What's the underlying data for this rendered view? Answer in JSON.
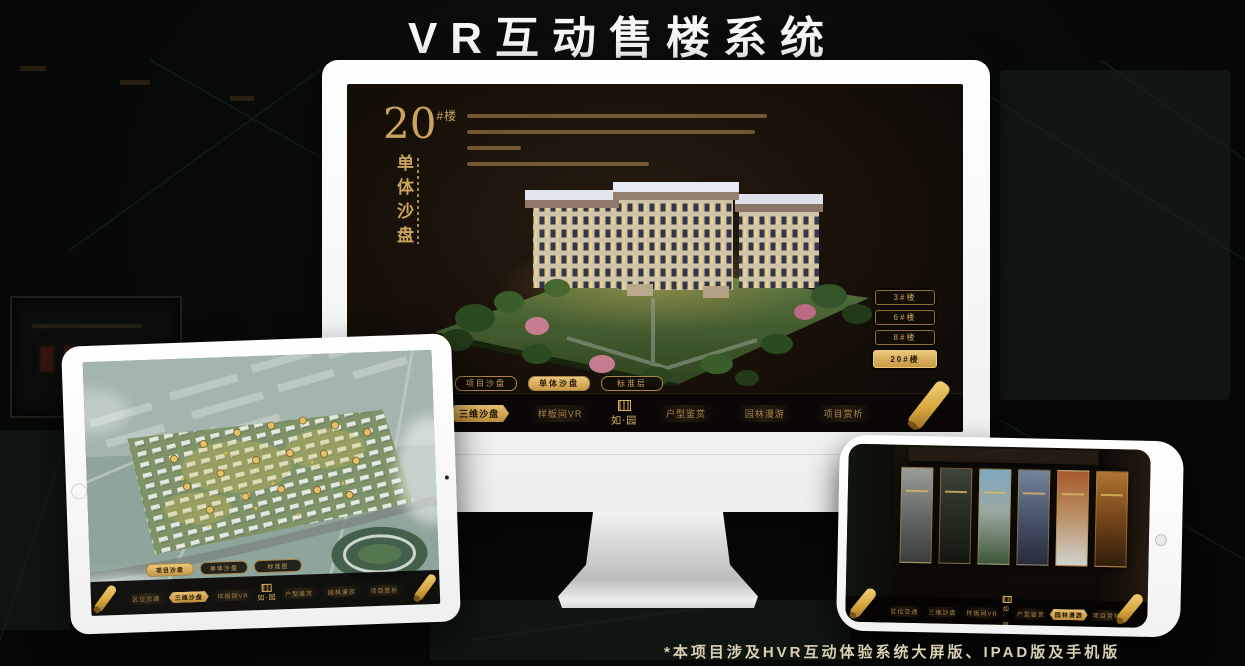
{
  "poster": {
    "title": "VR互动售楼系统",
    "footnote": "*本项目涉及HVR互动体验系统大屏版、IPAD版及手机版"
  },
  "colors": {
    "gold": "#c9a45c",
    "gold_bright": "#ecc87c",
    "screen_bg": "#171009",
    "nav_bg": "#0a0706"
  },
  "logo": {
    "name": "如·园"
  },
  "monitor": {
    "floor_number": "20",
    "floor_suffix": "#楼",
    "section_title": "单体沙盘",
    "building_buttons": [
      {
        "label": "3#楼",
        "active": false
      },
      {
        "label": "6#楼",
        "active": false
      },
      {
        "label": "8#楼",
        "active": false
      },
      {
        "label": "20#楼",
        "active": true
      }
    ],
    "view_tabs": [
      {
        "label": "项目沙盘",
        "active": false
      },
      {
        "label": "单体沙盘",
        "active": true
      },
      {
        "label": "标准层",
        "active": false
      }
    ],
    "nav_items": [
      {
        "label": "区位交通",
        "active": false
      },
      {
        "label": "三维沙盘",
        "active": true
      },
      {
        "label": "样板间VR",
        "active": false
      },
      {
        "label": "户型鉴赏",
        "active": false
      },
      {
        "label": "园林漫游",
        "active": false
      },
      {
        "label": "项目赏析",
        "active": false
      }
    ]
  },
  "tablet": {
    "view_tabs": [
      {
        "label": "项目沙盘",
        "active": true
      },
      {
        "label": "单体沙盘",
        "active": false
      },
      {
        "label": "标准层",
        "active": false
      }
    ],
    "nav_items": [
      {
        "label": "区位交通",
        "active": false
      },
      {
        "label": "三维沙盘",
        "active": true
      },
      {
        "label": "样板间VR",
        "active": false
      },
      {
        "label": "户型鉴赏",
        "active": false
      },
      {
        "label": "园林漫游",
        "active": false
      },
      {
        "label": "项目赏析",
        "active": false
      }
    ]
  },
  "phone": {
    "nav_items": [
      {
        "label": "区位交通",
        "active": false
      },
      {
        "label": "三维沙盘",
        "active": false
      },
      {
        "label": "样板间VR",
        "active": false
      },
      {
        "label": "户型鉴赏",
        "active": false
      },
      {
        "label": "园林漫游",
        "active": true
      },
      {
        "label": "项目赏析",
        "active": false
      }
    ]
  }
}
